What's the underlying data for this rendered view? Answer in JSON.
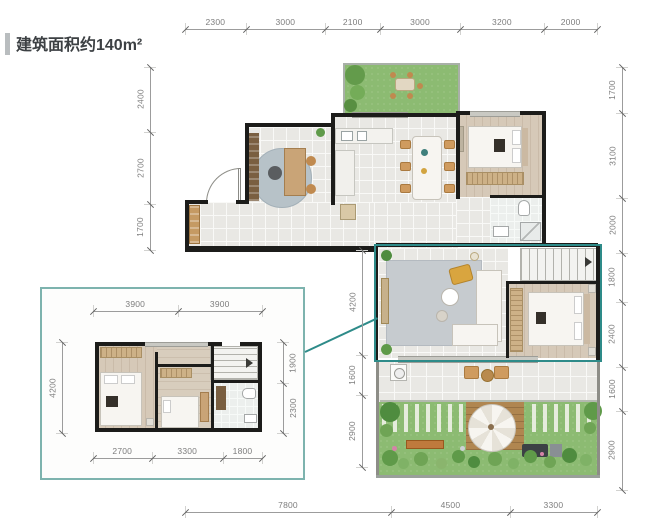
{
  "title": {
    "text": "建筑面积约140m²"
  },
  "dimensions": {
    "top": [
      "2300",
      "3000",
      "2100",
      "3000",
      "3200",
      "2000"
    ],
    "left_main": [
      "2400",
      "2700",
      "1700"
    ],
    "middle_vertical": [
      "4200",
      "1600",
      "2900"
    ],
    "right_main": [
      "1700",
      "3100",
      "2000",
      "1800",
      "2400",
      "1600",
      "2900"
    ],
    "bottom": [
      "7800",
      "4500",
      "3300"
    ],
    "inset_top": [
      "3900",
      "3900"
    ],
    "inset_left": [
      "4200"
    ],
    "inset_right": [
      "1900",
      "2300"
    ],
    "inset_bottom": [
      "2700",
      "3300",
      "1800"
    ]
  },
  "colors": {
    "accent_teal": "#2e8b89",
    "inset_border": "#7db3ae",
    "wall_black": "#1c1c1a",
    "floor_tile": "#e9e8e4",
    "wood_floor": "#d6c9b8",
    "garden_green": "#8cbb72",
    "dimension_text": "#7d7d7d"
  }
}
